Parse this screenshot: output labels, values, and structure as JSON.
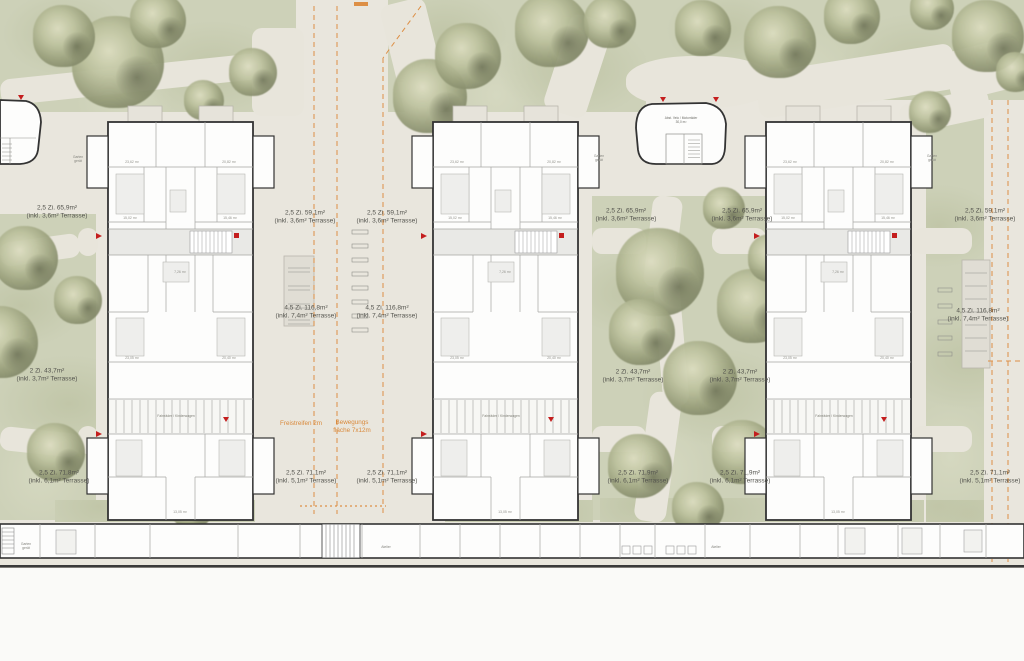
{
  "plan": {
    "unit_labels": [
      {
        "size": "2,5 Zi. 65,9m²",
        "terrace": "(inkl. 3,6m² Terrasse)",
        "x": 57,
        "y": 213
      },
      {
        "size": "2,5 Zi. 59,1m²",
        "terrace": "(inkl. 3,6m² Terrasse)",
        "x": 305,
        "y": 218
      },
      {
        "size": "2,5 Zi. 59,1m²",
        "terrace": "(inkl. 3,6m² Terrasse)",
        "x": 387,
        "y": 218
      },
      {
        "size": "2,5 Zi. 65,9m²",
        "terrace": "(inkl. 3,6m² Terrasse)",
        "x": 626,
        "y": 216
      },
      {
        "size": "2,5 Zi. 65,9m²",
        "terrace": "(inkl. 3,6m² Terrasse)",
        "x": 742,
        "y": 216
      },
      {
        "size": "2,5 Zi. 59,1m²",
        "terrace": "(inkl. 3,6m² Terrasse)",
        "x": 985,
        "y": 216
      },
      {
        "size": "4,5 Zi. 116,8m²",
        "terrace": "(inkl. 7,4m² Terrasse)",
        "x": 306,
        "y": 313
      },
      {
        "size": "4,5 Zi. 116,8m²",
        "terrace": "(inkl. 7,4m² Terrasse)",
        "x": 387,
        "y": 313
      },
      {
        "size": "4,5 Zi. 116,8m²",
        "terrace": "(inkl. 7,4m² Terrasse)",
        "x": 978,
        "y": 316
      },
      {
        "size": "2 Zi. 43,7m²",
        "terrace": "(inkl. 3,7m² Terrasse)",
        "x": 47,
        "y": 376
      },
      {
        "size": "2 Zi. 43,7m²",
        "terrace": "(inkl. 3,7m² Terrasse)",
        "x": 633,
        "y": 377
      },
      {
        "size": "2 Zi. 43,7m²",
        "terrace": "(inkl. 3,7m² Terrasse)",
        "x": 740,
        "y": 377
      },
      {
        "size": "2,5 Zi. 71,8m²",
        "terrace": "(inkl. 6,1m² Terrasse)",
        "x": 59,
        "y": 478
      },
      {
        "size": "2,5 Zi. 71,1m²",
        "terrace": "(inkl. 5,1m² Terrasse)",
        "x": 306,
        "y": 478
      },
      {
        "size": "2,5 Zi. 71,1m²",
        "terrace": "(inkl. 5,1m² Terrasse)",
        "x": 387,
        "y": 478
      },
      {
        "size": "2,5 Zi. 71,9m²",
        "terrace": "(inkl. 6,1m² Terrasse)",
        "x": 638,
        "y": 478
      },
      {
        "size": "2,5 Zi. 71,9m²",
        "terrace": "(inkl. 6,1m² Terrasse)",
        "x": 740,
        "y": 478
      },
      {
        "size": "2,5 Zi. 71,1m²",
        "terrace": "(inkl. 5,1m² Terrasse)",
        "x": 990,
        "y": 478
      }
    ],
    "zone_labels": [
      {
        "line1": "Freistreifen 2m",
        "line2": ""
      },
      {
        "line1": "Bewegungs",
        "line2": "fläche 7x12m"
      }
    ],
    "room_labels": {
      "bike": "Fahrräder / Kinderwagen",
      "garden_line1": "Garten",
      "garden_line2": "gerät",
      "atelier": "Atelier",
      "pavilion_line1": "Abst. Velo / Motorräder",
      "pavilion_line2": "30,0 m²"
    },
    "garden_positions": [
      [
        78,
        159
      ],
      [
        599,
        158
      ],
      [
        932,
        158
      ],
      [
        26,
        546
      ]
    ],
    "atelier_positions": [
      [
        386,
        547
      ],
      [
        716,
        547
      ]
    ],
    "area_values": [
      "23,62 m²",
      "20,82 m²",
      "15,02 m²",
      "15,46 m²",
      "7,26 m²",
      "23,05 m²",
      "20,40 m²",
      "13,05 m²"
    ],
    "buildings": [
      {
        "x": 108
      },
      {
        "x": 433
      },
      {
        "x": 766
      }
    ],
    "trees": [
      [
        118,
        62,
        92
      ],
      [
        64,
        36,
        62
      ],
      [
        158,
        20,
        56
      ],
      [
        253,
        72,
        48
      ],
      [
        204,
        100,
        40
      ],
      [
        430,
        96,
        74
      ],
      [
        468,
        56,
        66
      ],
      [
        552,
        30,
        74
      ],
      [
        610,
        22,
        52
      ],
      [
        703,
        28,
        56
      ],
      [
        780,
        42,
        72
      ],
      [
        852,
        16,
        56
      ],
      [
        932,
        8,
        44
      ],
      [
        988,
        36,
        72
      ],
      [
        1016,
        72,
        40
      ],
      [
        26,
        258,
        64
      ],
      [
        2,
        342,
        72
      ],
      [
        78,
        300,
        48
      ],
      [
        56,
        452,
        58
      ],
      [
        146,
        470,
        66
      ],
      [
        192,
        508,
        42
      ],
      [
        660,
        272,
        88
      ],
      [
        642,
        332,
        66
      ],
      [
        700,
        378,
        74
      ],
      [
        754,
        306,
        74
      ],
      [
        724,
        208,
        42
      ],
      [
        772,
        258,
        48
      ],
      [
        640,
        466,
        64
      ],
      [
        744,
        452,
        64
      ],
      [
        698,
        508,
        52
      ],
      [
        930,
        112,
        42
      ]
    ],
    "colors": {
      "accent_orange": "#d9893b",
      "marker_red": "#c41e1e",
      "wall": "#333333",
      "grass": "#cdd1b8",
      "path": "#e8e5db",
      "tree_dark": "#737858"
    }
  }
}
